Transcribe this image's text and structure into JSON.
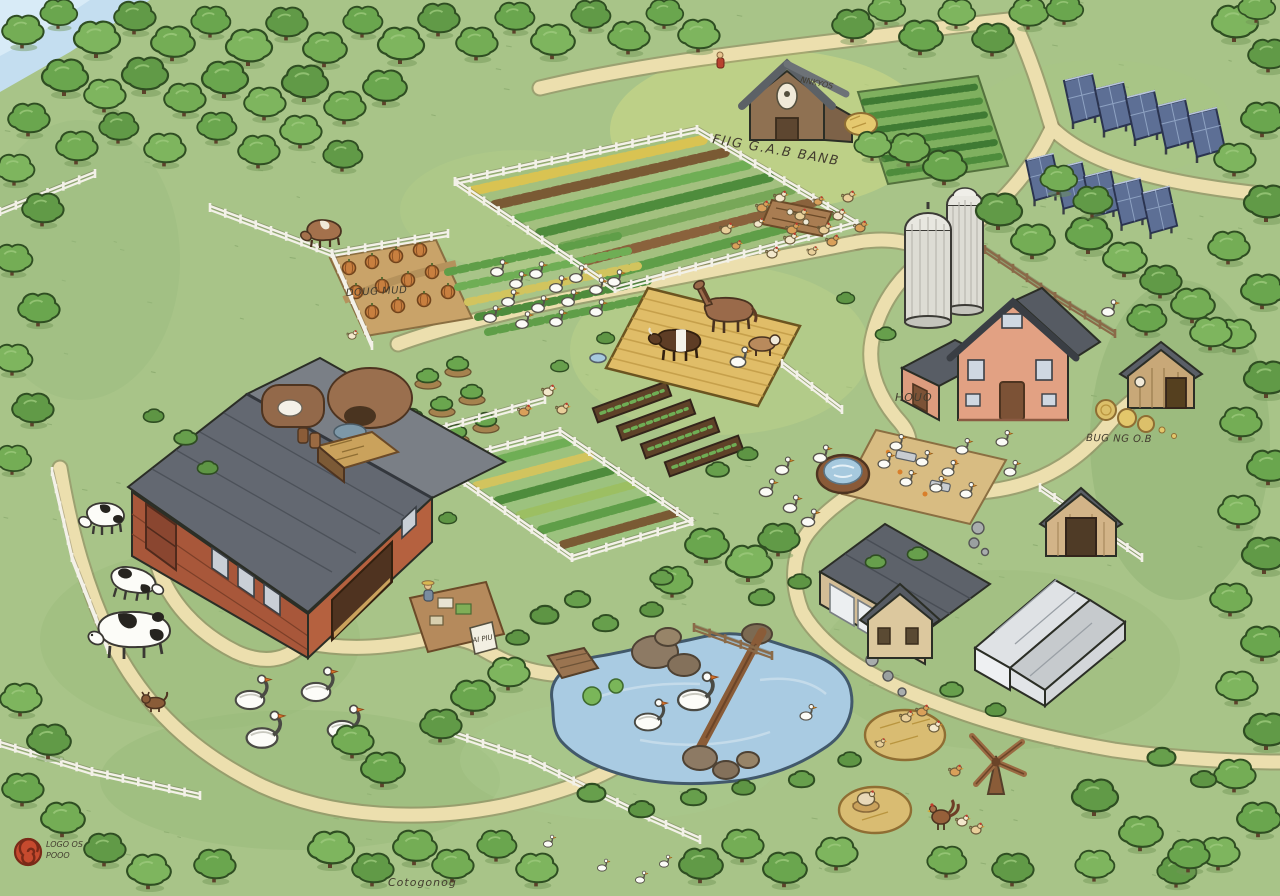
{
  "illustration": {
    "labels": {
      "field_sign": "FIIG G.A.B BANB",
      "barn_scribble": "NNKYOS",
      "pumpkin_patch": "DOUG MUD",
      "farmhouse": "HOUO",
      "hay_shed": "BUG NG O.B",
      "stand_sign": "AI PIU",
      "logo_line1": "LOGO OS",
      "logo_line2": "POOO",
      "bottom_note": "Cotogonog"
    },
    "colors": {
      "grass": "#a8c488",
      "path": "#ecdfae",
      "tree": "#74ad55",
      "pond": "#a9cbe2",
      "barn_wall": "#a8573a",
      "barn_roof": "#636871",
      "farmhouse_wall": "#dd9c7e",
      "solar_panel": "#5d6f95",
      "straw": "#e0bd68",
      "silo": "#dddcd4",
      "logo": "#c64a2e"
    }
  }
}
